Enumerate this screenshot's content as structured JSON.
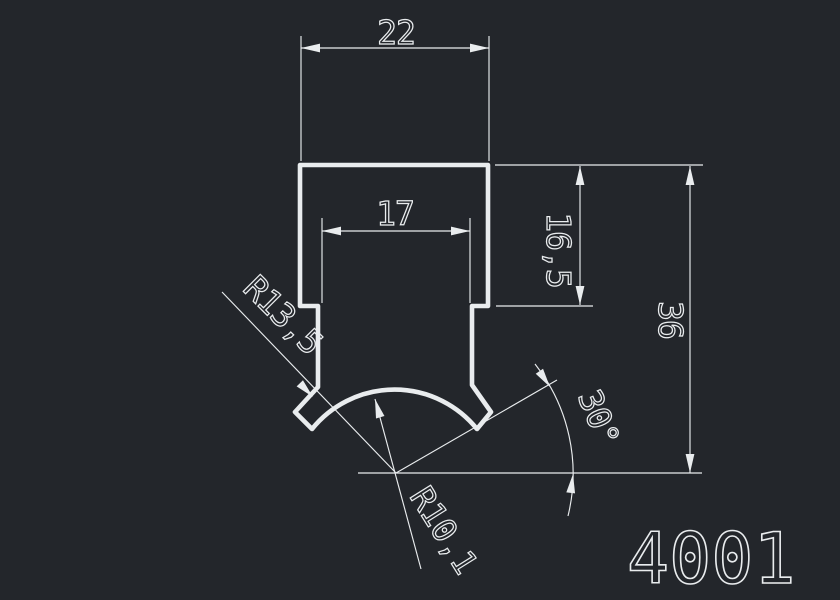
{
  "colors": {
    "background": "#23262b",
    "line": "#e9ecee"
  },
  "part_number": "4001",
  "dims": {
    "top_width": "22",
    "slot_width": "17",
    "shoulder_height": "16,5",
    "overall_height": "36",
    "outer_radius": "R13,5",
    "groove_radius": "R10,1",
    "angle": "30°"
  }
}
